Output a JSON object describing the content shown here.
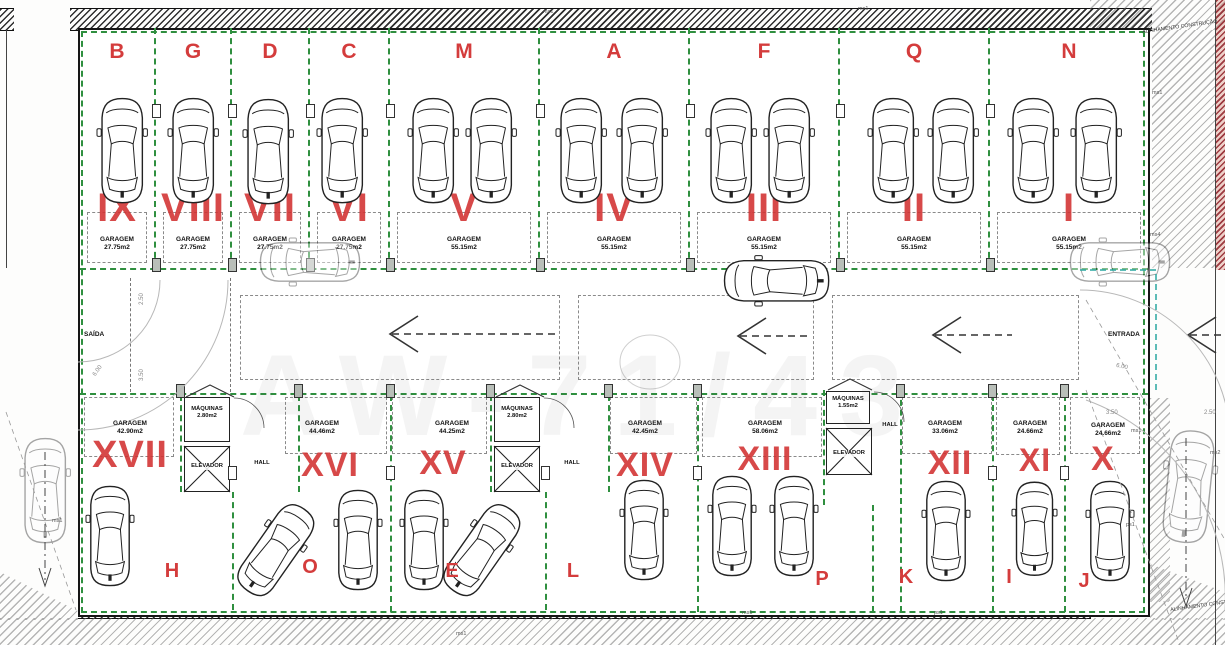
{
  "top_bays": [
    {
      "letter": "B",
      "numeral": "IX",
      "room": "GARAGEM",
      "area": "27.75m2",
      "cars": 1
    },
    {
      "letter": "G",
      "numeral": "VIII",
      "room": "GARAGEM",
      "area": "27.75m2",
      "cars": 1
    },
    {
      "letter": "D",
      "numeral": "VII",
      "room": "GARAGEM",
      "area": "27.75m2",
      "cars": 1
    },
    {
      "letter": "C",
      "numeral": "VI",
      "room": "GARAGEM",
      "area": "27.75m2",
      "cars": 1
    },
    {
      "letter": "M",
      "numeral": "V",
      "room": "GARAGEM",
      "area": "55.15m2",
      "cars": 2
    },
    {
      "letter": "A",
      "numeral": "IV",
      "room": "GARAGEM",
      "area": "55.15m2",
      "cars": 2
    },
    {
      "letter": "F",
      "numeral": "III",
      "room": "GARAGEM",
      "area": "55.15m2",
      "cars": 2
    },
    {
      "letter": "Q",
      "numeral": "II",
      "room": "GARAGEM",
      "area": "55.15m2",
      "cars": 2
    },
    {
      "letter": "N",
      "numeral": "I",
      "room": "GARAGEM",
      "area": "55.15m2",
      "cars": 2
    }
  ],
  "bottom_bays": [
    {
      "numeral": "XVII",
      "letter": "H",
      "room": "GARAGEM",
      "area": "42.90m2",
      "cars": 1
    },
    {
      "numeral": "XVI",
      "letter": "O",
      "room": "GARAGEM",
      "area": "44.46m2",
      "cars": 2
    },
    {
      "numeral": "XV",
      "letter": "E",
      "room": "GARAGEM",
      "area": "44.25m2",
      "cars": 2
    },
    {
      "numeral": "XIV",
      "letter": "L",
      "room": "GARAGEM",
      "area": "42.45m2",
      "cars": 1
    },
    {
      "numeral": "XIII",
      "letter": "P",
      "room": "GARAGEM",
      "area": "58.06m2",
      "cars": 2
    },
    {
      "numeral": "XII",
      "letter": "K",
      "room": "GARAGEM",
      "area": "33.06m2",
      "cars": 1
    },
    {
      "numeral": "XI",
      "letter": "I",
      "room": "GARAGEM",
      "area": "24.66m2",
      "cars": 1
    },
    {
      "numeral": "X",
      "letter": "J",
      "room": "GARAGEM",
      "area": "24.66m2",
      "cars": 1
    }
  ],
  "service_blocks": [
    {
      "machines": "MÁQUINAS",
      "machines_area": "2.80m2",
      "elevator": "ELEVADOR",
      "hall": "HALL"
    },
    {
      "machines": "MÁQUINAS",
      "machines_area": "2.80m2",
      "elevator": "ELEVADOR",
      "hall": "HALL"
    },
    {
      "machines": "MÁQUINAS",
      "machines_area": "1.55m2",
      "elevator": "ELEVADOR",
      "hall": "HALL"
    }
  ],
  "aisle": {
    "exit": "SAÍDA",
    "entrance": "ENTRADA"
  },
  "annotations": {
    "align": "ALINHAMENTO CONSTRUÇÃO",
    "ms1": "ms1",
    "ms2": "ms2",
    "ms4": "ms4",
    "ps1": "ps1",
    "d250": "2.50",
    "d350": "3.50",
    "d600": "6.00",
    "watermark": "AW-71/43"
  }
}
